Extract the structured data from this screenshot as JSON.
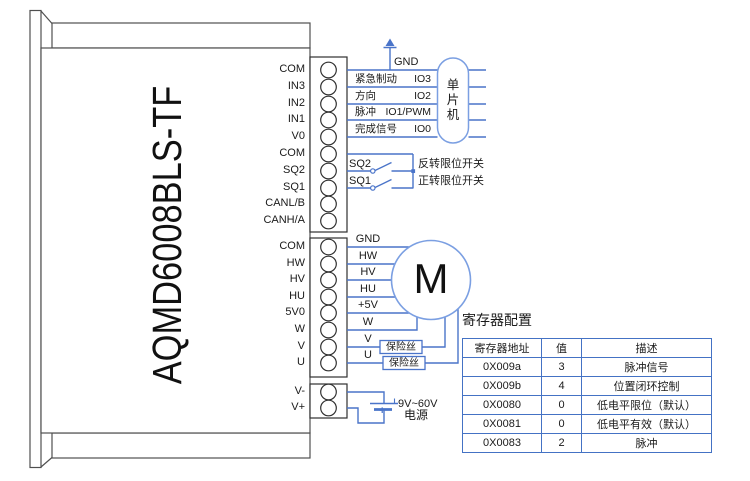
{
  "device": {
    "model": "AQMD6008BLS-TF"
  },
  "pins": {
    "upper": [
      "COM",
      "IN3",
      "IN2",
      "IN1",
      "V0",
      "COM",
      "SQ2",
      "SQ1",
      "CANL/B",
      "CANH/A"
    ],
    "motor": [
      "COM",
      "HW",
      "HV",
      "HU",
      "5V0",
      "W",
      "V",
      "U"
    ],
    "power": [
      "V-",
      "V+"
    ]
  },
  "io": {
    "gnd": "GND",
    "rows": [
      {
        "cn": "紧急制动",
        "io": "IO3"
      },
      {
        "cn": "方向",
        "io": "IO2"
      },
      {
        "cn": "脉冲",
        "io": "IO1/PWM"
      },
      {
        "cn": "完成信号",
        "io": "IO0"
      }
    ]
  },
  "mcu": {
    "chars": [
      "单",
      "片",
      "机"
    ]
  },
  "limit_switches": {
    "sq2": {
      "pin": "SQ2",
      "label": "反转限位开关"
    },
    "sq1": {
      "pin": "SQ1",
      "label": "正转限位开关"
    }
  },
  "motor": {
    "symbol": "M",
    "wire_labels": [
      "GND",
      "HW",
      "HV",
      "HU",
      "+5V",
      "W",
      "V",
      "U"
    ],
    "fuse": "保险丝"
  },
  "power_supply": {
    "voltage": "9V~60V",
    "name": "电源",
    "polarity": "+"
  },
  "register_config": {
    "title": "寄存器配置",
    "columns": [
      "寄存器地址",
      "值",
      "描述"
    ],
    "rows": [
      [
        "0X009a",
        "3",
        "脉冲信号"
      ],
      [
        "0X009b",
        "4",
        "位置闭环控制"
      ],
      [
        "0X0080",
        "0",
        "低电平限位（默认）"
      ],
      [
        "0X0081",
        "0",
        "低电平有效（默认）"
      ],
      [
        "0X0083",
        "2",
        "脉冲"
      ]
    ]
  }
}
